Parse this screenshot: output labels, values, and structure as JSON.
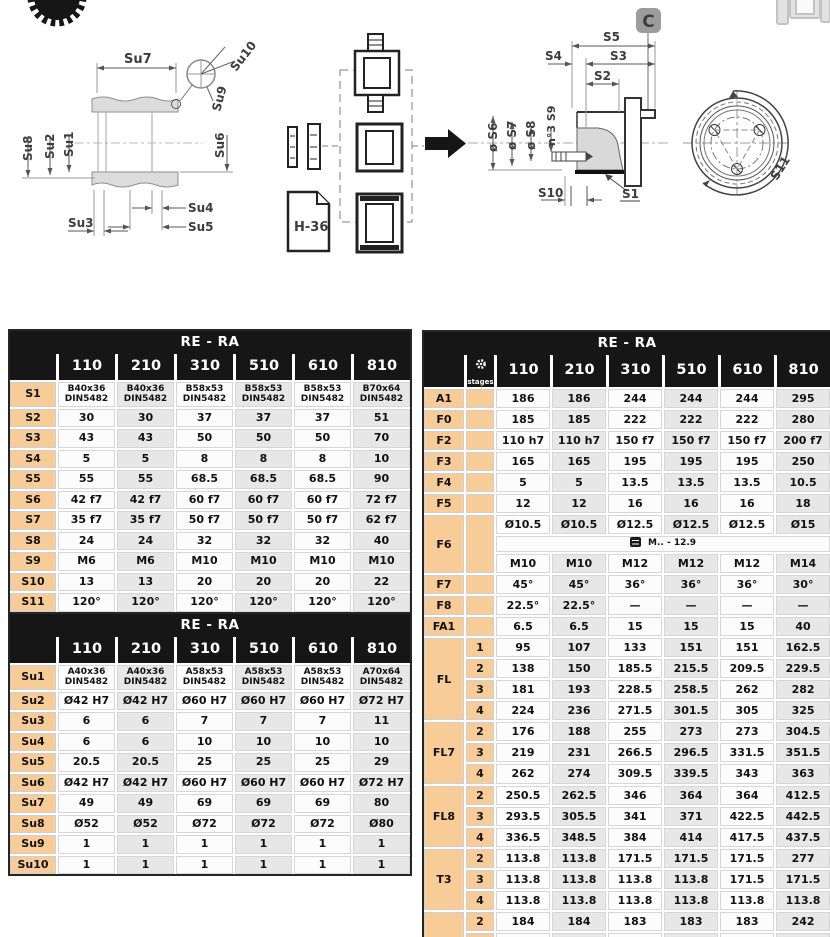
{
  "drawing": {
    "su1": "Su1",
    "su2": "Su2",
    "su3": "Su3",
    "su4": "Su4",
    "su5": "Su5",
    "su6": "Su6",
    "su7": "Su7",
    "su8": "Su8",
    "su9": "Su9",
    "su10": "Su10",
    "s1": "S1",
    "s2": "S2",
    "s3": "S3",
    "s4": "S4",
    "s5": "S5",
    "s6": "ø S6",
    "s7": "ø S7",
    "s8": "ø S8",
    "s9": "n°3 S9",
    "s10": "S10",
    "s11": "S11",
    "h36": "H-36",
    "c_badge": "C"
  },
  "tables": {
    "s_table": {
      "title": "RE - RA",
      "columns": [
        "110",
        "210",
        "310",
        "510",
        "610",
        "810"
      ],
      "rows": [
        {
          "label": "S1",
          "cls": "two-line",
          "values": [
            "B40x36\nDIN5482",
            "B40x36\nDIN5482",
            "B58x53\nDIN5482",
            "B58x53\nDIN5482",
            "B58x53\nDIN5482",
            "B70x64\nDIN5482"
          ]
        },
        {
          "label": "S2",
          "values": [
            "30",
            "30",
            "37",
            "37",
            "37",
            "51"
          ]
        },
        {
          "label": "S3",
          "values": [
            "43",
            "43",
            "50",
            "50",
            "50",
            "70"
          ]
        },
        {
          "label": "S4",
          "values": [
            "5",
            "5",
            "8",
            "8",
            "8",
            "10"
          ]
        },
        {
          "label": "S5",
          "values": [
            "55",
            "55",
            "68.5",
            "68.5",
            "68.5",
            "90"
          ]
        },
        {
          "label": "S6",
          "values": [
            "42 f7",
            "42 f7",
            "60 f7",
            "60 f7",
            "60 f7",
            "72 f7"
          ]
        },
        {
          "label": "S7",
          "values": [
            "35 f7",
            "35 f7",
            "50 f7",
            "50 f7",
            "50 f7",
            "62 f7"
          ]
        },
        {
          "label": "S8",
          "values": [
            "24",
            "24",
            "32",
            "32",
            "32",
            "40"
          ]
        },
        {
          "label": "S9",
          "values": [
            "M6",
            "M6",
            "M10",
            "M10",
            "M10",
            "M10"
          ]
        },
        {
          "label": "S10",
          "values": [
            "13",
            "13",
            "20",
            "20",
            "20",
            "22"
          ]
        },
        {
          "label": "S11",
          "values": [
            "120°",
            "120°",
            "120°",
            "120°",
            "120°",
            "120°"
          ]
        }
      ]
    },
    "su_table": {
      "title": "RE - RA",
      "columns": [
        "110",
        "210",
        "310",
        "510",
        "610",
        "810"
      ],
      "rows": [
        {
          "label": "Su1",
          "cls": "two-line",
          "values": [
            "A40x36\nDIN5482",
            "A40x36\nDIN5482",
            "A58x53\nDIN5482",
            "A58x53\nDIN5482",
            "A58x53\nDIN5482",
            "A70x64\nDIN5482"
          ]
        },
        {
          "label": "Su2",
          "values": [
            "Ø42 H7",
            "Ø42 H7",
            "Ø60 H7",
            "Ø60 H7",
            "Ø60 H7",
            "Ø72 H7"
          ]
        },
        {
          "label": "Su3",
          "values": [
            "6",
            "6",
            "7",
            "7",
            "7",
            "11"
          ]
        },
        {
          "label": "Su4",
          "values": [
            "6",
            "6",
            "10",
            "10",
            "10",
            "10"
          ]
        },
        {
          "label": "Su5",
          "values": [
            "20.5",
            "20.5",
            "25",
            "25",
            "25",
            "29"
          ]
        },
        {
          "label": "Su6",
          "values": [
            "Ø42 H7",
            "Ø42 H7",
            "Ø60 H7",
            "Ø60 H7",
            "Ø60 H7",
            "Ø72 H7"
          ]
        },
        {
          "label": "Su7",
          "values": [
            "49",
            "49",
            "69",
            "69",
            "69",
            "80"
          ]
        },
        {
          "label": "Su8",
          "values": [
            "Ø52",
            "Ø52",
            "Ø72",
            "Ø72",
            "Ø72",
            "Ø80"
          ]
        },
        {
          "label": "Su9",
          "values": [
            "1",
            "1",
            "1",
            "1",
            "1",
            "1"
          ]
        },
        {
          "label": "Su10",
          "values": [
            "1",
            "1",
            "1",
            "1",
            "1",
            "1"
          ]
        }
      ]
    },
    "ra_table": {
      "title": "RE - RA",
      "stages_label": "stages",
      "has_stages": true,
      "columns": [
        "110",
        "210",
        "310",
        "510",
        "610",
        "810"
      ],
      "rows": [
        {
          "label": "A1",
          "values": [
            "186",
            "186",
            "244",
            "244",
            "244",
            "295"
          ]
        },
        {
          "label": "F0",
          "values": [
            "185",
            "185",
            "222",
            "222",
            "222",
            "280"
          ]
        },
        {
          "label": "F2",
          "values": [
            "110 h7",
            "110 h7",
            "150 f7",
            "150 f7",
            "150 f7",
            "200 f7"
          ]
        },
        {
          "label": "F3",
          "values": [
            "165",
            "165",
            "195",
            "195",
            "195",
            "250"
          ]
        },
        {
          "label": "F4",
          "values": [
            "5",
            "5",
            "13.5",
            "13.5",
            "13.5",
            "10.5"
          ]
        },
        {
          "label": "F5",
          "values": [
            "12",
            "12",
            "16",
            "16",
            "16",
            "18"
          ]
        },
        {
          "label": "F6",
          "sub": [
            {
              "stage": "",
              "values": [
                "Ø10.5",
                "Ø10.5",
                "Ø12.5",
                "Ø12.5",
                "Ø12.5",
                "Ø15"
              ]
            },
            {
              "stage": "",
              "span": "M.. - 12.9"
            },
            {
              "stage": "",
              "values": [
                "M10",
                "M10",
                "M12",
                "M12",
                "M12",
                "M14"
              ]
            }
          ]
        },
        {
          "label": "F7",
          "values": [
            "45°",
            "45°",
            "36°",
            "36°",
            "36°",
            "30°"
          ]
        },
        {
          "label": "F8",
          "values": [
            "22.5°",
            "22.5°",
            "—",
            "—",
            "—",
            "—"
          ]
        },
        {
          "label": "FA1",
          "values": [
            "6.5",
            "6.5",
            "15",
            "15",
            "15",
            "40"
          ]
        },
        {
          "label": "FL",
          "sub": [
            {
              "stage": "1",
              "values": [
                "95",
                "107",
                "133",
                "151",
                "151",
                "162.5"
              ]
            },
            {
              "stage": "2",
              "values": [
                "138",
                "150",
                "185.5",
                "215.5",
                "209.5",
                "229.5"
              ]
            },
            {
              "stage": "3",
              "values": [
                "181",
                "193",
                "228.5",
                "258.5",
                "262",
                "282"
              ]
            },
            {
              "stage": "4",
              "values": [
                "224",
                "236",
                "271.5",
                "301.5",
                "305",
                "325"
              ]
            }
          ]
        },
        {
          "label": "FL7",
          "sub": [
            {
              "stage": "2",
              "values": [
                "176",
                "188",
                "255",
                "273",
                "273",
                "304.5"
              ]
            },
            {
              "stage": "3",
              "values": [
                "219",
                "231",
                "266.5",
                "296.5",
                "331.5",
                "351.5"
              ]
            },
            {
              "stage": "4",
              "values": [
                "262",
                "274",
                "309.5",
                "339.5",
                "343",
                "363"
              ]
            }
          ]
        },
        {
          "label": "FL8",
          "sub": [
            {
              "stage": "2",
              "values": [
                "250.5",
                "262.5",
                "346",
                "364",
                "364",
                "412.5"
              ]
            },
            {
              "stage": "3",
              "values": [
                "293.5",
                "305.5",
                "341",
                "371",
                "422.5",
                "442.5"
              ]
            },
            {
              "stage": "4",
              "values": [
                "336.5",
                "348.5",
                "384",
                "414",
                "417.5",
                "437.5"
              ]
            }
          ]
        },
        {
          "label": "T3",
          "sub": [
            {
              "stage": "2",
              "values": [
                "113.8",
                "113.8",
                "171.5",
                "171.5",
                "171.5",
                "277"
              ]
            },
            {
              "stage": "3",
              "values": [
                "113.8",
                "113.8",
                "113.8",
                "113.8",
                "171.5",
                "171.5"
              ]
            },
            {
              "stage": "4",
              "values": [
                "113.8",
                "113.8",
                "113.8",
                "113.8",
                "113.8",
                "113.8"
              ]
            }
          ]
        },
        {
          "label": "T4",
          "sub": [
            {
              "stage": "2",
              "values": [
                "184",
                "184",
                "183",
                "183",
                "183",
                "242"
              ]
            },
            {
              "stage": "3",
              "values": [
                "184",
                "184",
                "184",
                "184",
                "183",
                "183"
              ]
            },
            {
              "stage": "4",
              "values": [
                "184",
                "184",
                "184",
                "184",
                "184",
                "184"
              ]
            }
          ]
        }
      ]
    }
  }
}
